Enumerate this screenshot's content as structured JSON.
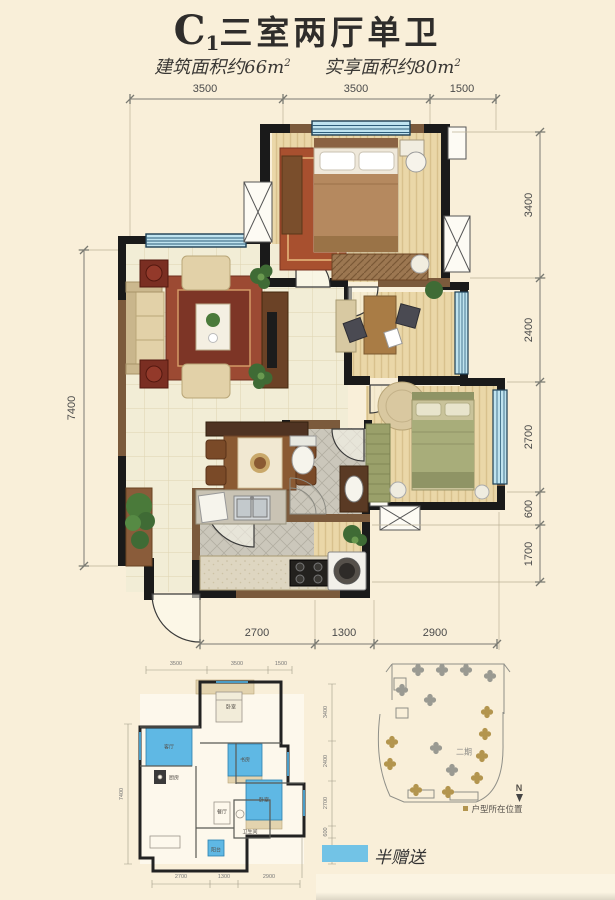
{
  "page": {
    "background": "#f9efd9"
  },
  "header": {
    "title_prefix": "C",
    "title_subscript": "1",
    "title_text": "三室两厅单卫",
    "area_items": [
      {
        "text": "建筑面积约66m",
        "sup": "2"
      },
      {
        "text": "实享面积约80m",
        "sup": "2"
      }
    ]
  },
  "main_plan": {
    "dims_top": [
      "3500",
      "3500",
      "1500"
    ],
    "dims_right": [
      "3400",
      "2400",
      "2700",
      "600",
      "1700"
    ],
    "dims_left": [
      "7400"
    ],
    "dims_bottom": [
      "2700",
      "1300",
      "2900"
    ]
  },
  "small_plan": {
    "dims_top": [
      "3500",
      "3500",
      "1500"
    ],
    "dims_right": [
      "3400",
      "2400",
      "2700",
      "600",
      "1700"
    ],
    "dims_left": [
      "7400"
    ],
    "dims_bottom": [
      "2700",
      "1300",
      "2900"
    ],
    "room_labels": {
      "bedroom_top": "卧室",
      "living": "客厅",
      "study": "书房",
      "bedroom_right": "卧室",
      "kitchen": "厨房",
      "dining": "餐厅",
      "bath": "卫生间",
      "balcony": "阳台"
    },
    "highlight_color": "#5fb8e4"
  },
  "site_plan": {
    "phase_label": "二期",
    "north_label": "N",
    "location_legend": "户型所在位置",
    "highlight_color": "#b3954e"
  },
  "footer_legend": {
    "swatch_color": "#72c3e6",
    "label": "半赠送"
  }
}
